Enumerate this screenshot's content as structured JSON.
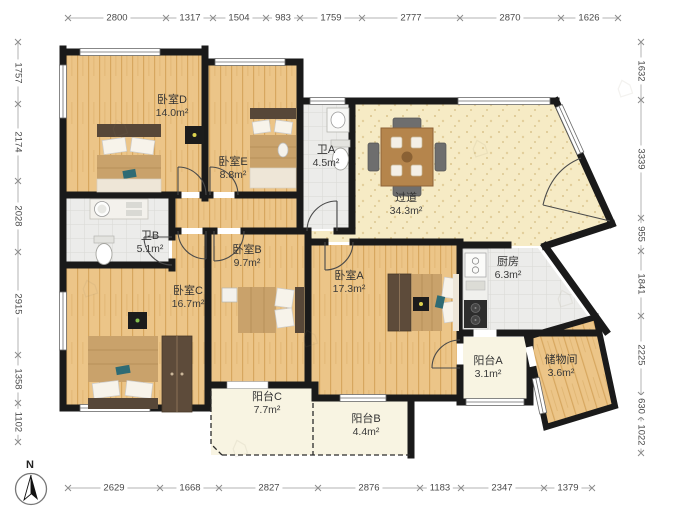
{
  "rooms": {
    "bedroom_d": {
      "name": "卧室D",
      "area": "14.0m²"
    },
    "bedroom_e": {
      "name": "卧室E",
      "area": "8.8m²"
    },
    "bath_a": {
      "name": "卫A",
      "area": "4.5m²"
    },
    "hallway": {
      "name": "过道",
      "area": "34.3m²"
    },
    "bath_b": {
      "name": "卫B",
      "area": "5.1m²"
    },
    "bedroom_c": {
      "name": "卧室C",
      "area": "16.7m²"
    },
    "bedroom_b": {
      "name": "卧室B",
      "area": "9.7m²"
    },
    "bedroom_a": {
      "name": "卧室A",
      "area": "17.3m²"
    },
    "kitchen": {
      "name": "厨房",
      "area": "6.3m²"
    },
    "balcony_a": {
      "name": "阳台A",
      "area": "3.1m²"
    },
    "storage": {
      "name": "储物间",
      "area": "3.6m²"
    },
    "balcony_c": {
      "name": "阳台C",
      "area": "7.7m²"
    },
    "balcony_b": {
      "name": "阳台B",
      "area": "4.4m²"
    }
  },
  "compass": {
    "label": "N"
  },
  "dims": {
    "top": [
      "2800",
      "1317",
      "1504",
      "983",
      "1759",
      "2777",
      "2870",
      "1626"
    ],
    "left": [
      "1757",
      "2174",
      "2028",
      "2915",
      "1358",
      "1102"
    ],
    "right": [
      "1632",
      "3339",
      "955",
      "1841",
      "2225",
      "630",
      "1022"
    ],
    "bottom": [
      "2629",
      "1668",
      "2827",
      "2876",
      "1183",
      "2347",
      "1379"
    ]
  },
  "colors": {
    "wall": "#1a1a1a",
    "wood_floor": "#ecc588",
    "hall_floor": "#f6ebc5",
    "tile_floor": "#ececea",
    "balcony_floor": "#f8f4e2",
    "dimension_text": "#4a4a4a"
  },
  "watermark": {
    "glyph": "⌂"
  }
}
